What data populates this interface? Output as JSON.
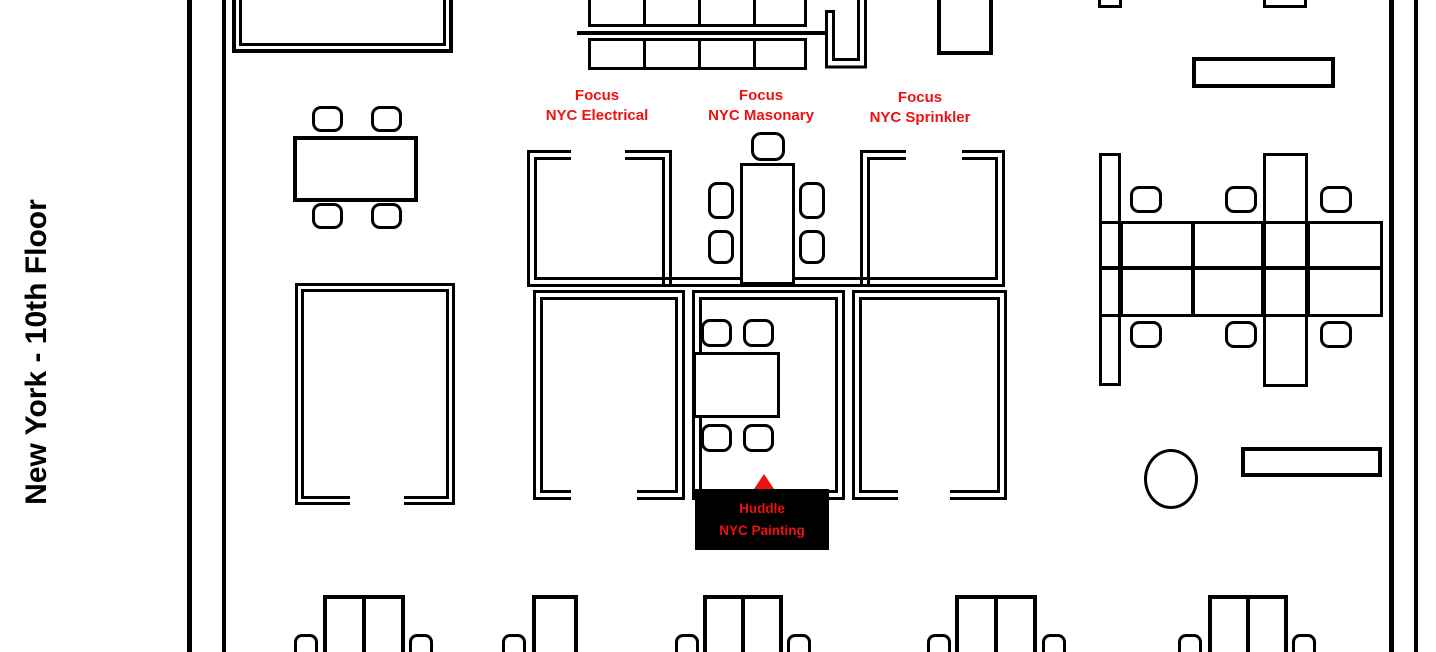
{
  "title": "New York - 10th Floor",
  "colors": {
    "accent_red": "#ee1111",
    "line_black": "#000000",
    "background": "#ffffff"
  },
  "rooms": {
    "focus_electrical": {
      "line1": "Focus",
      "line2": "NYC Electrical"
    },
    "focus_masonary": {
      "line1": "Focus",
      "line2": "NYC Masonary"
    },
    "focus_sprinkler": {
      "line1": "Focus",
      "line2": "NYC Sprinkler"
    },
    "huddle_painting": {
      "line1": "Huddle",
      "line2": "NYC Painting"
    }
  },
  "marker": {
    "shape": "triangle-up",
    "color": "#ee1111"
  }
}
